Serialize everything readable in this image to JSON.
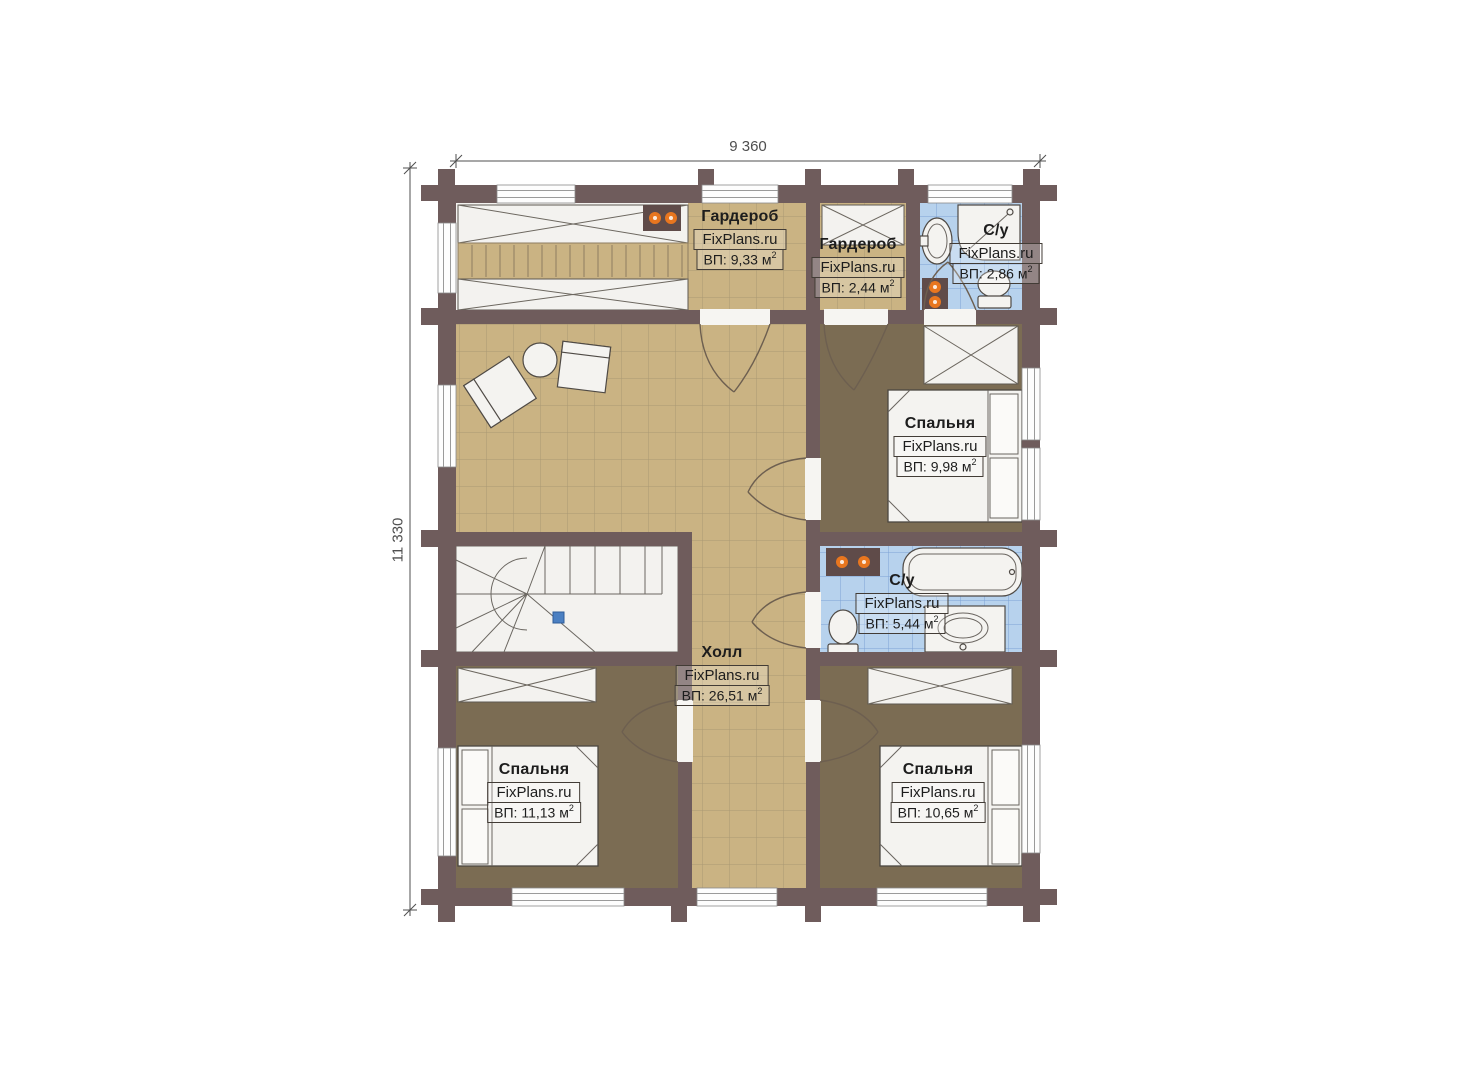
{
  "plan": {
    "dimensions": {
      "top": "9 360",
      "left": "11 330"
    },
    "rooms": [
      {
        "key": "wardrobe-large",
        "name": "Гардероб",
        "site": "FixPlans.ru",
        "area": "ВП: 9,33 м",
        "sup": "2"
      },
      {
        "key": "wardrobe-small",
        "name": "Гардероб",
        "site": "FixPlans.ru",
        "area": "ВП: 2,44 м",
        "sup": "2"
      },
      {
        "key": "bathroom-small",
        "name": "С/у",
        "site": "FixPlans.ru",
        "area": "ВП: 2,86 м",
        "sup": "2"
      },
      {
        "key": "bedroom-top",
        "name": "Спальня",
        "site": "FixPlans.ru",
        "area": "ВП: 9,98 м",
        "sup": "2"
      },
      {
        "key": "bathroom-main",
        "name": "С/у",
        "site": "FixPlans.ru",
        "area": "ВП: 5,44 м",
        "sup": "2"
      },
      {
        "key": "hall",
        "name": "Холл",
        "site": "FixPlans.ru",
        "area": "ВП: 26,51 м",
        "sup": "2"
      },
      {
        "key": "bedroom-left",
        "name": "Спальня",
        "site": "FixPlans.ru",
        "area": "ВП: 11,13 м",
        "sup": "2"
      },
      {
        "key": "bedroom-right",
        "name": "Спальня",
        "site": "FixPlans.ru",
        "area": "ВП: 10,65 м",
        "sup": "2"
      }
    ],
    "colors": {
      "wall": "#6f5c5c",
      "floorTan": "#cab383",
      "groutTan": "#9f8e6d",
      "floorBedroom": "#7b6c53",
      "floorBath": "#b7d2ed",
      "groutBath": "#6d96cf",
      "fixture": "#f4f3f0",
      "radiator": "#e8761f",
      "accentBlue": "#4b80c2",
      "dimension": "#4f4f4f",
      "labelText": "#1d1d1d"
    }
  }
}
